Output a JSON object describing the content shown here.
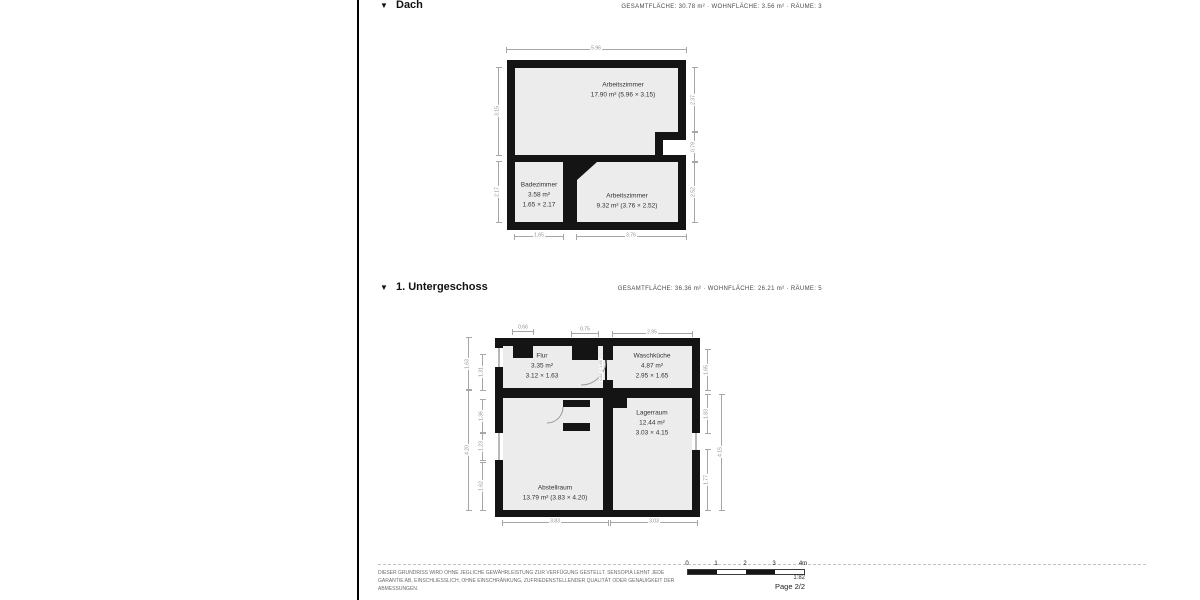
{
  "app": {
    "collapse_icon": "▼"
  },
  "sections": [
    {
      "title": "Dach",
      "stats": "GESAMTFLÄCHE: 30.78 m² · WOHNFLÄCHE: 3.56 m² · RÄUME: 3"
    },
    {
      "title": "1. Untergeschoss",
      "stats": "GESAMTFLÄCHE: 36.36 m² · WOHNFLÄCHE: 26.21 m² · RÄUME: 5"
    }
  ],
  "dach": {
    "rooms": {
      "arbeitszimmer_top": {
        "name": "Arbeitszimmer",
        "detail": "17.90 m² (5.96 × 3.15)"
      },
      "badezimmer": {
        "name": "Badezimmer",
        "area": "3.58 m²",
        "size": "1.65 × 2.17"
      },
      "arbeitszimmer_bottom": {
        "name": "Arbeitszimmer",
        "detail": "9.32 m² (3.76 × 2.52)"
      }
    },
    "dims": {
      "top": "5.96",
      "left_top": "3.15",
      "left_bottom": "2.17",
      "right_top": "2.37",
      "right_mid": "0.79",
      "right_bottom": "2.52",
      "bottom_left": "1.65",
      "bottom_right": "3.76"
    }
  },
  "untergeschoss": {
    "rooms": {
      "flur": {
        "name": "Flur",
        "area": "3.35 m²",
        "size": "3.12 × 1.63"
      },
      "waschkueche": {
        "name": "Waschküche",
        "area": "4.87 m²",
        "size": "2.95 × 1.65"
      },
      "lagerraum": {
        "name": "Lagerraum",
        "area": "12.44 m²",
        "size": "3.03 × 4.15"
      },
      "abstellraum": {
        "name": "Abstellraum",
        "detail": "13.79 m² (3.83 × 4.20)"
      }
    },
    "dims": {
      "top_left": "0.66",
      "top_mid": "0.75",
      "top_right": "2.95",
      "left_outer_top": "1.63",
      "left_outer_bottom": "4.20",
      "left_inner_1": "1.31",
      "left_inner_2": "1.36",
      "left_inner_3": "1.23",
      "left_inner_4": "1.62",
      "right_inner_1": "1.65",
      "right_inner_2": "1.83",
      "right_inner_3": "1.77",
      "right_outer": "4.15",
      "bottom_left": "3.83",
      "bottom_right": "3.03",
      "door_height": "1.65",
      "door_width": "0.82"
    }
  },
  "footer": {
    "disclaimer": "DIESER GRUNDRISS WIRD OHNE JEGLICHE GEWÄHRLEISTUNG ZUR VERFÜGUNG GESTELLT. SENSOPIA LEHNT JEDE GARANTIE AB, EINSCHLIESSLICH, OHNE EINSCHRÄNKUNG, ZUFRIEDENSTELLENDER QUALITÄT ODER GENAUIGKEIT DER ABMESSUNGEN.",
    "scale_ticks": [
      "0",
      "1",
      "2",
      "3",
      "4m"
    ],
    "scale_ratio": "1:82",
    "page_label": "Page 2/2"
  }
}
